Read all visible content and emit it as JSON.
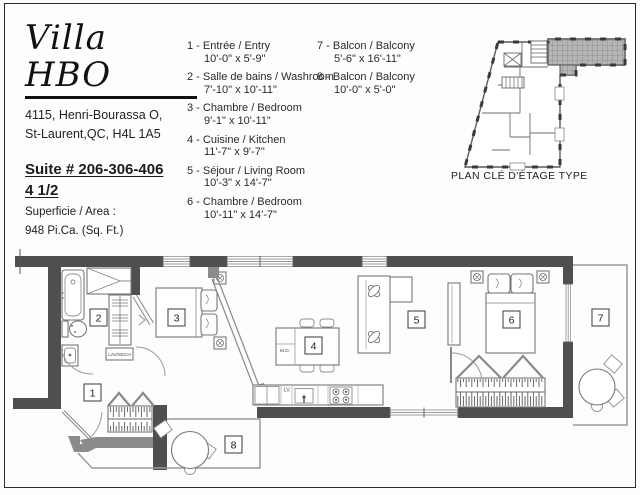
{
  "header": {
    "title": "Villa HBO",
    "address_line1": "4115, Henri-Bourassa O,",
    "address_line2": "St-Laurent,QC, H4L 1A5",
    "suite": "Suite # 206-306-406",
    "unit_type": "4 1/2",
    "area_label": "Superficie / Area :",
    "area_value": "948 Pi.Ca. (Sq. Ft.)"
  },
  "legend": {
    "items": [
      {
        "number": "1",
        "label": "1 - Entrée / Entry",
        "dims": "10'-0\" x 5'-9\""
      },
      {
        "number": "2",
        "label": "2 - Salle de bains / Washroom",
        "dims": "7'-10\" x 10'-11\""
      },
      {
        "number": "3",
        "label": "3 - Chambre / Bedroom",
        "dims": "9'-1\" x 10'-11\""
      },
      {
        "number": "4",
        "label": "4 - Cuisine / Kitchen",
        "dims": "11'-7\" x 9'-7\""
      },
      {
        "number": "5",
        "label": "5 - Séjour / Living Room",
        "dims": "10'-3\" x 14'-7\""
      },
      {
        "number": "6",
        "label": "6 - Chambre / Bedroom",
        "dims": "10'-11\" x 14'-7\""
      },
      {
        "number": "7",
        "label": "7 - Balcon / Balcony",
        "dims": "5'-6\" x 16'-11\""
      },
      {
        "number": "8",
        "label": "8 - Balcon / Balcony",
        "dims": "10'-0\" x 5'-0\""
      }
    ]
  },
  "keyplan": {
    "caption": "PLAN CLÉ D'ÉTAGE TYPE"
  },
  "floorplan": {
    "room_numbers": [
      "1",
      "2",
      "3",
      "4",
      "5",
      "6",
      "7",
      "8"
    ],
    "annotations": {
      "laundry": "LAV/SECH",
      "microwave": "M.O.",
      "dishwasher": "LV."
    }
  },
  "colors": {
    "wall_dark": "#4f4f4f",
    "wall_medium": "#8b8b8b",
    "window_line": "#9b9b9b",
    "balcony_outline": "#9a9a9a",
    "text": "#1c1c1c"
  }
}
